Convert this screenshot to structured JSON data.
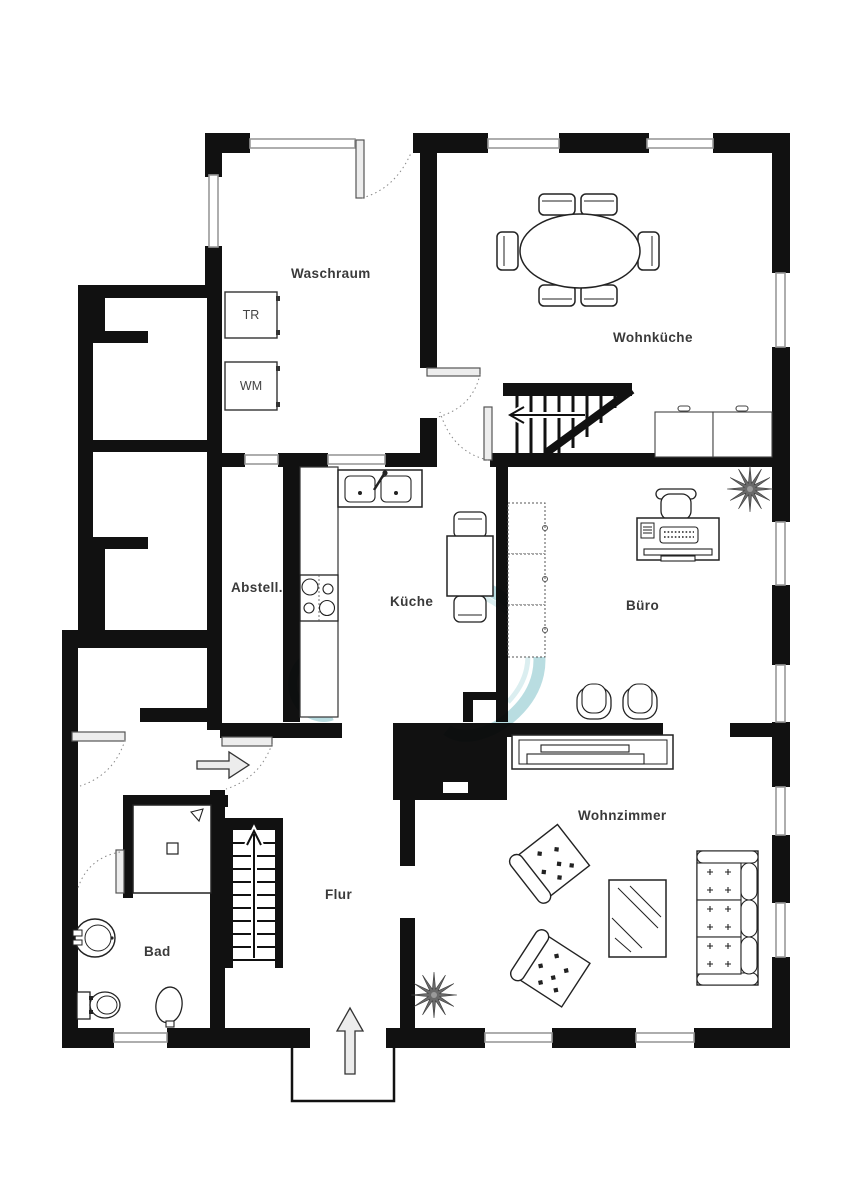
{
  "rooms": {
    "waschraum": {
      "label": "Waschraum"
    },
    "wohnkueche": {
      "label": "Wohnküche"
    },
    "abstellraum": {
      "label": "Abstell."
    },
    "kueche": {
      "label": "Küche"
    },
    "buero": {
      "label": "Büro"
    },
    "wohnzimmer": {
      "label": "Wohnzimmer"
    },
    "flur": {
      "label": "Flur"
    },
    "bad": {
      "label": "Bad"
    }
  },
  "appliances": {
    "dryer": {
      "label": "TR"
    },
    "washer": {
      "label": "WM"
    }
  },
  "symbols": [
    "dining-table-with-six-chairs",
    "kitchen-counter",
    "double-sink",
    "stove-four-burners",
    "kitchen-table-with-two-chairs",
    "wall-cabinets",
    "desk-with-computer",
    "office-chair",
    "visitor-chairs",
    "tv-sideboard",
    "armchair",
    "coffee-table",
    "sofa-three-seats",
    "shower",
    "washbasin",
    "toilet",
    "bidet",
    "staircase-up",
    "staircase-down",
    "entrance-arrow",
    "plant",
    "chimney"
  ],
  "colors": {
    "wall": "#111111",
    "furniture_outline": "#222222",
    "label_text": "#3a3a3a",
    "window_line": "#999999",
    "door_leaf": "#ededed",
    "watermark": "#a8d5da",
    "background": "#ffffff"
  }
}
